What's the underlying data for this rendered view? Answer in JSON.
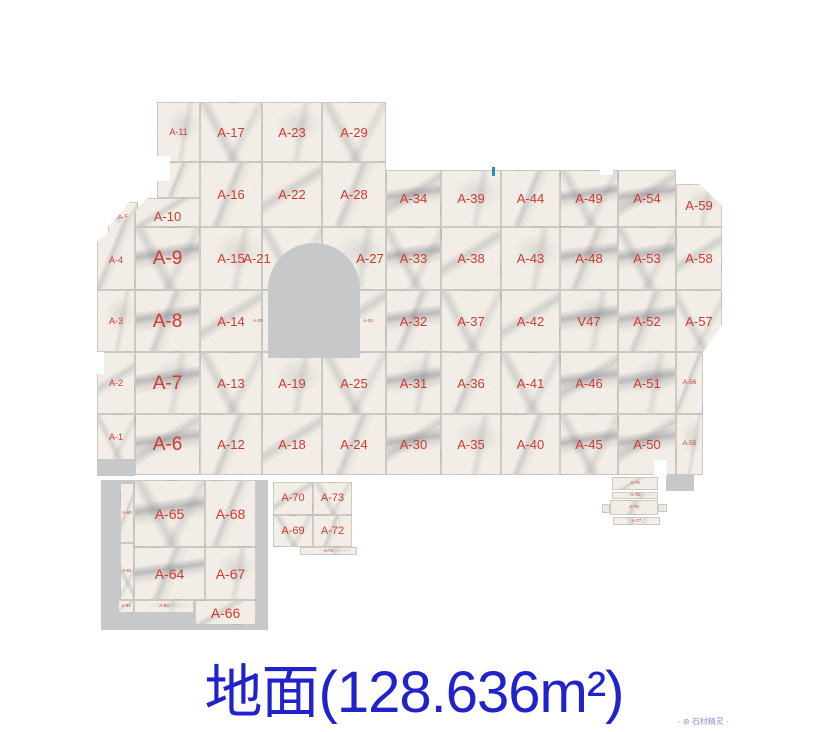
{
  "title": {
    "text": "地面(128.636m²)"
  },
  "watermark": {
    "text": "- ⊛ 石材精灵 -"
  },
  "colors": {
    "label_red": "#ce3a2e",
    "title_blue": "#2222cc",
    "deco_gray": "#c7c8ca",
    "tick_teal": "#2b8fb0"
  },
  "layout": {
    "title_top": 645,
    "title_size": 58,
    "wm_left": 678,
    "wm_top": 716,
    "wm_size": 8
  },
  "floor": {
    "tiles": [
      {
        "l": "A-11",
        "x": 157,
        "y": 102,
        "w": 43,
        "h": 60,
        "s": "sm"
      },
      {
        "l": "A-17",
        "x": 200,
        "y": 102,
        "w": 62,
        "h": 60,
        "s": "md"
      },
      {
        "l": "A-23",
        "x": 262,
        "y": 102,
        "w": 60,
        "h": 60,
        "s": "md"
      },
      {
        "l": "A-29",
        "x": 322,
        "y": 102,
        "w": 64,
        "h": 60,
        "s": "md"
      },
      {
        "l": "",
        "x": 157,
        "y": 162,
        "w": 43,
        "h": 36
      },
      {
        "l": "A-16",
        "x": 200,
        "y": 162,
        "w": 62,
        "h": 65,
        "s": "md"
      },
      {
        "l": "A-22",
        "x": 262,
        "y": 162,
        "w": 60,
        "h": 65,
        "s": "md"
      },
      {
        "l": "A-28",
        "x": 322,
        "y": 162,
        "w": 64,
        "h": 65,
        "s": "md"
      },
      {
        "l": "A-10",
        "x": 135,
        "y": 198,
        "w": 65,
        "h": 29,
        "s": "md",
        "dy": 4,
        "clip": "tl10"
      },
      {
        "l": "A-5",
        "x": 108,
        "y": 202,
        "w": 30,
        "h": 32,
        "s": "xs",
        "clip": "a5"
      },
      {
        "l": "A-34",
        "x": 386,
        "y": 170,
        "w": 55,
        "h": 57,
        "s": "md",
        "strong": true
      },
      {
        "l": "A-39",
        "x": 441,
        "y": 170,
        "w": 60,
        "h": 57,
        "s": "md"
      },
      {
        "l": "A-44",
        "x": 501,
        "y": 170,
        "w": 59,
        "h": 57,
        "s": "md"
      },
      {
        "l": "A-49",
        "x": 560,
        "y": 170,
        "w": 58,
        "h": 57,
        "s": "md",
        "strong": true
      },
      {
        "l": "A-54",
        "x": 618,
        "y": 170,
        "w": 58,
        "h": 57,
        "s": "md",
        "strong": true
      },
      {
        "l": "A-59",
        "x": 676,
        "y": 184,
        "w": 46,
        "h": 43,
        "s": "md",
        "clip": "tr"
      },
      {
        "l": "A-4",
        "x": 97,
        "y": 210,
        "w": 38,
        "h": 80,
        "s": "sm",
        "dy": 10,
        "clip": "tl4"
      },
      {
        "l": "A-9",
        "x": 135,
        "y": 227,
        "w": 65,
        "h": 63,
        "s": "xl",
        "strong": true
      },
      {
        "l": "A-15",
        "x": 200,
        "y": 227,
        "w": 62,
        "h": 63,
        "s": "md"
      },
      {
        "l": "A-21",
        "x": 262,
        "y": 227,
        "w": 60,
        "h": 63,
        "s": "md",
        "dx": -35
      },
      {
        "l": "A-27",
        "x": 322,
        "y": 227,
        "w": 64,
        "h": 63,
        "s": "md",
        "dx": 16
      },
      {
        "l": "A-33",
        "x": 386,
        "y": 227,
        "w": 55,
        "h": 63,
        "s": "md",
        "strong": true
      },
      {
        "l": "A-38",
        "x": 441,
        "y": 227,
        "w": 60,
        "h": 63,
        "s": "md"
      },
      {
        "l": "A-43",
        "x": 501,
        "y": 227,
        "w": 59,
        "h": 63,
        "s": "md"
      },
      {
        "l": "A-48",
        "x": 560,
        "y": 227,
        "w": 58,
        "h": 63,
        "s": "md",
        "strong": true
      },
      {
        "l": "A-53",
        "x": 618,
        "y": 227,
        "w": 58,
        "h": 63,
        "s": "md",
        "strong": true
      },
      {
        "l": "A-58",
        "x": 676,
        "y": 227,
        "w": 46,
        "h": 63,
        "s": "md"
      },
      {
        "l": "A-3",
        "x": 97,
        "y": 290,
        "w": 38,
        "h": 62,
        "s": "sm"
      },
      {
        "l": "A-8",
        "x": 135,
        "y": 290,
        "w": 65,
        "h": 62,
        "s": "xl",
        "strong": true
      },
      {
        "l": "A-14",
        "x": 200,
        "y": 290,
        "w": 62,
        "h": 62,
        "s": "md"
      },
      {
        "l": "A-20",
        "x": 262,
        "y": 290,
        "w": 60,
        "h": 62,
        "s": "xxs",
        "dx": -34
      },
      {
        "l": "A-26",
        "x": 322,
        "y": 290,
        "w": 64,
        "h": 62,
        "s": "xxs",
        "dx": 14
      },
      {
        "l": "A-32",
        "x": 386,
        "y": 290,
        "w": 55,
        "h": 62,
        "s": "md",
        "strong": true
      },
      {
        "l": "A-37",
        "x": 441,
        "y": 290,
        "w": 60,
        "h": 62,
        "s": "md"
      },
      {
        "l": "A-42",
        "x": 501,
        "y": 290,
        "w": 59,
        "h": 62,
        "s": "md"
      },
      {
        "l": "V47",
        "x": 560,
        "y": 290,
        "w": 58,
        "h": 62,
        "s": "md",
        "strong": true
      },
      {
        "l": "A-52",
        "x": 618,
        "y": 290,
        "w": 58,
        "h": 62,
        "s": "md",
        "strong": true
      },
      {
        "l": "A-57",
        "x": 676,
        "y": 290,
        "w": 46,
        "h": 62,
        "s": "md",
        "clip": "br"
      },
      {
        "l": "A-2",
        "x": 97,
        "y": 352,
        "w": 38,
        "h": 62,
        "s": "sm"
      },
      {
        "l": "A-7",
        "x": 135,
        "y": 352,
        "w": 65,
        "h": 62,
        "s": "xl",
        "strong": true
      },
      {
        "l": "A-13",
        "x": 200,
        "y": 352,
        "w": 62,
        "h": 62,
        "s": "md"
      },
      {
        "l": "A-19",
        "x": 262,
        "y": 352,
        "w": 60,
        "h": 62,
        "s": "md"
      },
      {
        "l": "A-25",
        "x": 322,
        "y": 352,
        "w": 64,
        "h": 62,
        "s": "md"
      },
      {
        "l": "A-31",
        "x": 386,
        "y": 352,
        "w": 55,
        "h": 62,
        "s": "md",
        "strong": true
      },
      {
        "l": "A-36",
        "x": 441,
        "y": 352,
        "w": 60,
        "h": 62,
        "s": "md"
      },
      {
        "l": "A-41",
        "x": 501,
        "y": 352,
        "w": 59,
        "h": 62,
        "s": "md"
      },
      {
        "l": "A-46",
        "x": 560,
        "y": 352,
        "w": 58,
        "h": 62,
        "s": "md",
        "strong": true
      },
      {
        "l": "A-51",
        "x": 618,
        "y": 352,
        "w": 58,
        "h": 62,
        "s": "md",
        "strong": true
      },
      {
        "l": "A-56",
        "x": 676,
        "y": 352,
        "w": 27,
        "h": 62,
        "s": "xs"
      },
      {
        "l": "A-1",
        "x": 97,
        "y": 414,
        "w": 38,
        "h": 46,
        "s": "sm"
      },
      {
        "l": "A-6",
        "x": 135,
        "y": 414,
        "w": 65,
        "h": 61,
        "s": "xl",
        "strong": true
      },
      {
        "l": "A-12",
        "x": 200,
        "y": 414,
        "w": 62,
        "h": 61,
        "s": "md"
      },
      {
        "l": "A-18",
        "x": 262,
        "y": 414,
        "w": 60,
        "h": 61,
        "s": "md"
      },
      {
        "l": "A-24",
        "x": 322,
        "y": 414,
        "w": 64,
        "h": 61,
        "s": "md"
      },
      {
        "l": "A-30",
        "x": 386,
        "y": 414,
        "w": 55,
        "h": 61,
        "s": "md",
        "strong": true
      },
      {
        "l": "A-35",
        "x": 441,
        "y": 414,
        "w": 60,
        "h": 61,
        "s": "md"
      },
      {
        "l": "A-40",
        "x": 501,
        "y": 414,
        "w": 59,
        "h": 61,
        "s": "md"
      },
      {
        "l": "A-45",
        "x": 560,
        "y": 414,
        "w": 58,
        "h": 61,
        "s": "md",
        "strong": true
      },
      {
        "l": "A-50",
        "x": 618,
        "y": 414,
        "w": 58,
        "h": 61,
        "s": "md",
        "strong": true
      },
      {
        "l": "A-55",
        "x": 676,
        "y": 414,
        "w": 27,
        "h": 61,
        "s": "xs"
      },
      {
        "l": "A-60",
        "x": 120,
        "y": 483,
        "w": 14,
        "h": 60,
        "s": "xxs"
      },
      {
        "l": "A-61",
        "x": 120,
        "y": 543,
        "w": 14,
        "h": 57,
        "s": "xxs"
      },
      {
        "l": "A-65",
        "x": 134,
        "y": 480,
        "w": 71,
        "h": 67,
        "s": "lg",
        "strong": true
      },
      {
        "l": "A-68",
        "x": 205,
        "y": 480,
        "w": 51,
        "h": 67,
        "s": "lg"
      },
      {
        "l": "A-64",
        "x": 134,
        "y": 547,
        "w": 71,
        "h": 53,
        "s": "lg",
        "strong": true
      },
      {
        "l": "A-67",
        "x": 205,
        "y": 547,
        "w": 51,
        "h": 53,
        "s": "lg"
      },
      {
        "l": "A-66",
        "x": 195,
        "y": 600,
        "w": 61,
        "h": 25,
        "s": "lg"
      },
      {
        "l": "A-63",
        "x": 134,
        "y": 600,
        "w": 60,
        "h": 13,
        "s": "xxs"
      },
      {
        "l": "A-62",
        "x": 118,
        "y": 600,
        "w": 16,
        "h": 13,
        "s": "xxs"
      },
      {
        "l": "A-70",
        "x": 273,
        "y": 482,
        "w": 40,
        "h": 33,
        "s": "md2"
      },
      {
        "l": "A-73",
        "x": 313,
        "y": 482,
        "w": 39,
        "h": 33,
        "s": "md2"
      },
      {
        "l": "A-69",
        "x": 273,
        "y": 515,
        "w": 40,
        "h": 32,
        "s": "md2"
      },
      {
        "l": "A-72",
        "x": 313,
        "y": 515,
        "w": 39,
        "h": 32,
        "s": "md2"
      },
      {
        "l": "A-71",
        "x": 300,
        "y": 547,
        "w": 57,
        "h": 8,
        "s": "xxs"
      },
      {
        "l": "A-74",
        "x": 612,
        "y": 477,
        "w": 46,
        "h": 13,
        "s": "xxs"
      },
      {
        "l": "A-75",
        "x": 612,
        "y": 492,
        "w": 46,
        "h": 7,
        "s": "xxs"
      },
      {
        "l": "A-76",
        "x": 610,
        "y": 500,
        "w": 48,
        "h": 15,
        "s": "xxs"
      },
      {
        "l": "A-77",
        "x": 613,
        "y": 517,
        "w": 47,
        "h": 8,
        "s": "xxs"
      },
      {
        "l": "",
        "x": 602,
        "y": 504,
        "w": 8,
        "h": 9
      },
      {
        "l": "",
        "x": 658,
        "y": 504,
        "w": 9,
        "h": 8
      }
    ],
    "deco": [
      {
        "t": "backdrop",
        "n": "gray-backdrop",
        "x": 101,
        "y": 480,
        "w": 167,
        "h": 150
      },
      {
        "t": "arch",
        "n": "arch-cutout",
        "x": 268,
        "y": 243,
        "w": 92,
        "h": 115
      },
      {
        "t": "gray",
        "n": "gray-piece",
        "x": 97,
        "y": 460,
        "w": 38,
        "h": 16
      },
      {
        "t": "gray",
        "n": "gray-piece",
        "x": 666,
        "y": 475,
        "w": 28,
        "h": 16
      },
      {
        "t": "white",
        "n": "edge-notch",
        "x": 157,
        "y": 156,
        "w": 13,
        "h": 25
      },
      {
        "t": "white",
        "n": "edge-notch",
        "x": 93,
        "y": 352,
        "w": 11,
        "h": 22
      },
      {
        "t": "white",
        "n": "edge-notch",
        "x": 654,
        "y": 460,
        "w": 13,
        "h": 16
      },
      {
        "t": "white",
        "n": "edge-notch",
        "x": 600,
        "y": 167,
        "w": 13,
        "h": 8
      },
      {
        "t": "tick",
        "n": "blue-tick",
        "x": 492,
        "y": 167,
        "w": 3,
        "h": 9
      }
    ]
  }
}
